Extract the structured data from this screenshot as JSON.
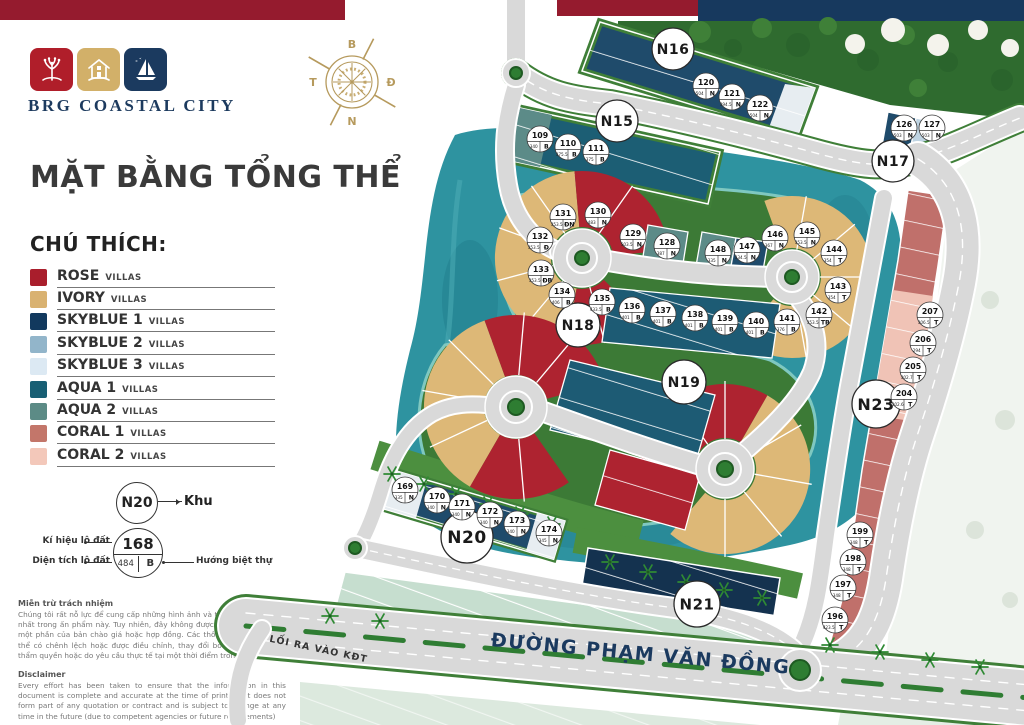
{
  "header": {
    "brand": "BRG COASTAL CITY",
    "title": "MẶT BẰNG TỔNG THỂ"
  },
  "legend": {
    "heading": "CHÚ THÍCH:",
    "suffix": "VILLAS",
    "items": [
      {
        "name": "ROSE",
        "color": "#A91E2C"
      },
      {
        "name": "IVORY",
        "color": "#D9B271"
      },
      {
        "name": "SKYBLUE 1",
        "color": "#12395E"
      },
      {
        "name": "SKYBLUE 2",
        "color": "#92B5CA"
      },
      {
        "name": "SKYBLUE 3",
        "color": "#DCE9F3"
      },
      {
        "name": "AQUA 1",
        "color": "#185F74"
      },
      {
        "name": "AQUA 2",
        "color": "#5C8B86"
      },
      {
        "name": "CORAL 1",
        "color": "#C3766A"
      },
      {
        "name": "CORAL 2",
        "color": "#F3C8BA"
      }
    ]
  },
  "key": {
    "zone_example": "N20",
    "zone_label": "Khu",
    "lot_example": {
      "id": "168",
      "area": "484",
      "dir": "B"
    },
    "lot_id_label": "Kí hiệu lô đất",
    "lot_area_label": "Diện tích lô đất",
    "lot_dir_label": "Hướng biệt thự"
  },
  "compass": {
    "north": "B",
    "east": "Đ",
    "south": "N",
    "west": "T"
  },
  "disclaimer_vi": {
    "heading": "Miễn trừ trách nhiệm",
    "body": "Chúng tôi rất nỗ lực để cung cấp những hình ảnh và thông tin chính xác nhất trong ấn phẩm này. Tuy nhiên, đây không được coi là cam kết hay một phần của bản chào giá hoặc hợp đồng. Các thông số, hình ảnh có thể có chênh lệch hoặc được điều chỉnh, thay đổi bởi các cơ quan có thẩm quyền hoặc do yêu cầu thực tế tại một thời điểm trong tương lai"
  },
  "disclaimer_en": {
    "heading": "Disclaimer",
    "body": "Every effort has been taken to ensure that the information in this document is complete and accurate at the time of printing. It does not form part of any quotation or contract and is subject to change at any time in the future (due to competent agencies or future requirements)"
  },
  "map": {
    "street": "ĐƯỜNG PHẠM VĂN ĐỒNG",
    "entrance": "LỐI RA VÀO KĐT",
    "zones": [
      {
        "id": "N15",
        "x": 617,
        "y": 121,
        "r": 21,
        "f": 14
      },
      {
        "id": "N16",
        "x": 673,
        "y": 49,
        "r": 21,
        "f": 14
      },
      {
        "id": "N17",
        "x": 893,
        "y": 161,
        "r": 21,
        "f": 14
      },
      {
        "id": "N18",
        "x": 578,
        "y": 325,
        "r": 22,
        "f": 14
      },
      {
        "id": "N19",
        "x": 684,
        "y": 382,
        "r": 22,
        "f": 14
      },
      {
        "id": "N20",
        "x": 467,
        "y": 537,
        "r": 26,
        "f": 17
      },
      {
        "id": "N21",
        "x": 697,
        "y": 604,
        "r": 23,
        "f": 15
      },
      {
        "id": "N23",
        "x": 876,
        "y": 404,
        "r": 24,
        "f": 16
      }
    ],
    "lots": [
      {
        "id": "109",
        "area": "340",
        "dir": "B",
        "x": 540,
        "y": 139
      },
      {
        "id": "110",
        "area": "375.5",
        "dir": "B",
        "x": 568,
        "y": 147
      },
      {
        "id": "111",
        "area": "375",
        "dir": "B",
        "x": 596,
        "y": 152
      },
      {
        "id": "120",
        "area": "504",
        "dir": "N",
        "x": 706,
        "y": 86
      },
      {
        "id": "121",
        "area": "394.5",
        "dir": "N",
        "x": 732,
        "y": 97
      },
      {
        "id": "122",
        "area": "504",
        "dir": "N",
        "x": 760,
        "y": 108
      },
      {
        "id": "126",
        "area": "503",
        "dir": "N",
        "x": 904,
        "y": 128
      },
      {
        "id": "127",
        "area": "503",
        "dir": "N",
        "x": 932,
        "y": 128
      },
      {
        "id": "128",
        "area": "387",
        "dir": "N",
        "x": 667,
        "y": 246
      },
      {
        "id": "129",
        "area": "503.5",
        "dir": "N",
        "x": 633,
        "y": 237
      },
      {
        "id": "130",
        "area": "483",
        "dir": "N",
        "x": 598,
        "y": 215
      },
      {
        "id": "131",
        "area": "353.5",
        "dir": "ĐN",
        "x": 563,
        "y": 217
      },
      {
        "id": "132",
        "area": "353.5",
        "dir": "Đ",
        "x": 540,
        "y": 240
      },
      {
        "id": "133",
        "area": "353.5",
        "dir": "ĐB",
        "x": 541,
        "y": 273
      },
      {
        "id": "134",
        "area": "406",
        "dir": "B",
        "x": 562,
        "y": 295
      },
      {
        "id": "135",
        "area": "433.5",
        "dir": "B",
        "x": 602,
        "y": 302
      },
      {
        "id": "136",
        "area": "401",
        "dir": "B",
        "x": 632,
        "y": 310
      },
      {
        "id": "137",
        "area": "401",
        "dir": "B",
        "x": 663,
        "y": 314
      },
      {
        "id": "138",
        "area": "401",
        "dir": "B",
        "x": 695,
        "y": 318
      },
      {
        "id": "139",
        "area": "401",
        "dir": "B",
        "x": 725,
        "y": 322
      },
      {
        "id": "140",
        "area": "401",
        "dir": "B",
        "x": 756,
        "y": 325
      },
      {
        "id": "141",
        "area": "376",
        "dir": "B",
        "x": 787,
        "y": 322
      },
      {
        "id": "142",
        "area": "353.5",
        "dir": "TB",
        "x": 819,
        "y": 315
      },
      {
        "id": "143",
        "area": "354",
        "dir": "T",
        "x": 838,
        "y": 290
      },
      {
        "id": "144",
        "area": "354",
        "dir": "T",
        "x": 834,
        "y": 253
      },
      {
        "id": "145",
        "area": "353.5",
        "dir": "N",
        "x": 807,
        "y": 235
      },
      {
        "id": "146",
        "area": "367",
        "dir": "N",
        "x": 775,
        "y": 238
      },
      {
        "id": "147",
        "area": "334.5",
        "dir": "N",
        "x": 747,
        "y": 250
      },
      {
        "id": "148",
        "area": "335",
        "dir": "N",
        "x": 718,
        "y": 253
      },
      {
        "id": "169",
        "area": "335",
        "dir": "N",
        "x": 405,
        "y": 490
      },
      {
        "id": "170",
        "area": "340",
        "dir": "N",
        "x": 437,
        "y": 500
      },
      {
        "id": "171",
        "area": "340",
        "dir": "N",
        "x": 462,
        "y": 507
      },
      {
        "id": "172",
        "area": "340",
        "dir": "N",
        "x": 490,
        "y": 515
      },
      {
        "id": "173",
        "area": "340",
        "dir": "N",
        "x": 517,
        "y": 524
      },
      {
        "id": "174",
        "area": "345",
        "dir": "N",
        "x": 549,
        "y": 533
      },
      {
        "id": "196",
        "area": "423.5",
        "dir": "T",
        "x": 835,
        "y": 620
      },
      {
        "id": "197",
        "area": "348",
        "dir": "T",
        "x": 843,
        "y": 588
      },
      {
        "id": "198",
        "area": "348",
        "dir": "T",
        "x": 853,
        "y": 562
      },
      {
        "id": "199",
        "area": "348",
        "dir": "T",
        "x": 860,
        "y": 535
      },
      {
        "id": "204",
        "area": "302.6",
        "dir": "T",
        "x": 904,
        "y": 397
      },
      {
        "id": "205",
        "area": "302.7",
        "dir": "T",
        "x": 913,
        "y": 370
      },
      {
        "id": "206",
        "area": "294",
        "dir": "T",
        "x": 923,
        "y": 343
      },
      {
        "id": "207",
        "area": "306.5",
        "dir": "T",
        "x": 930,
        "y": 315
      }
    ]
  }
}
